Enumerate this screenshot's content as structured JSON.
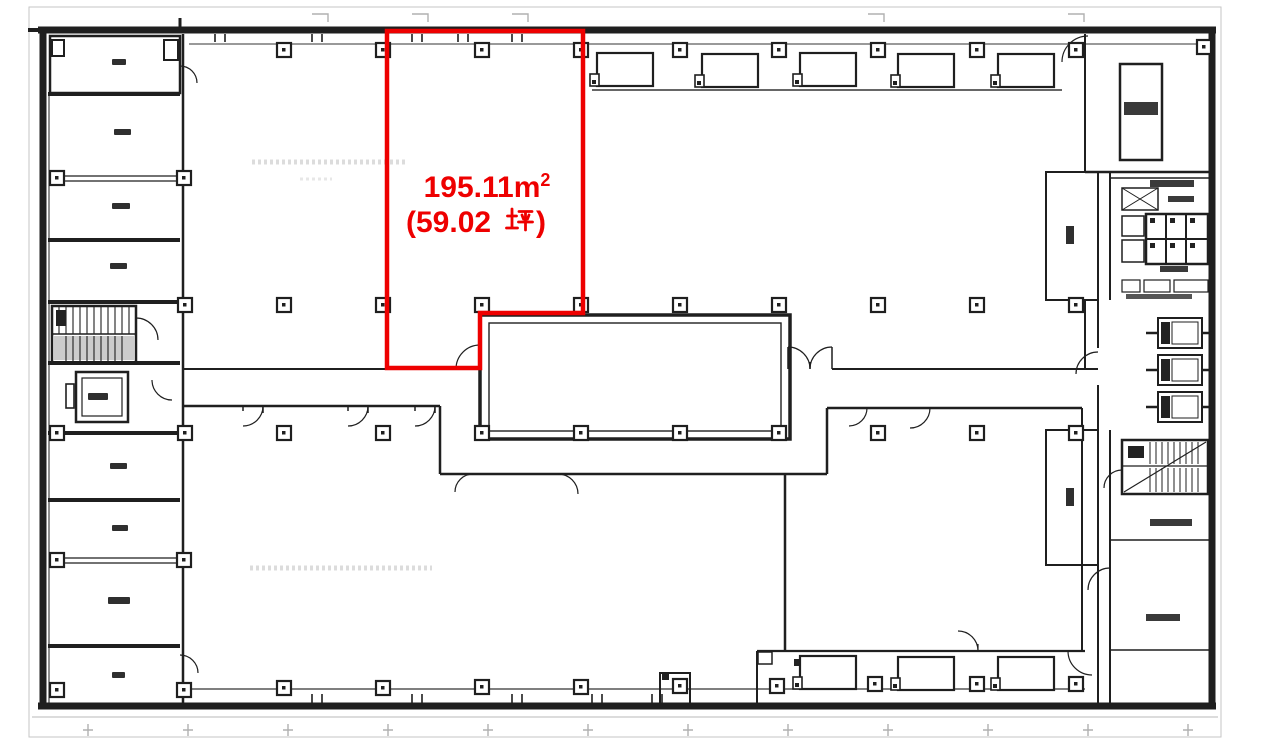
{
  "plan": {
    "background": "#ffffff",
    "ink": "#1f1f1f",
    "faint": "#c6c6c6",
    "highlight": {
      "color": "#ee0000",
      "area_value": "195.11",
      "unit_base": "m",
      "unit_sup": "2",
      "tsubo_open": "(59.02",
      "tsubo_kanji": "坪",
      "tsubo_close": ")",
      "full_label": "195.11㎡ (59.02坪)"
    }
  }
}
